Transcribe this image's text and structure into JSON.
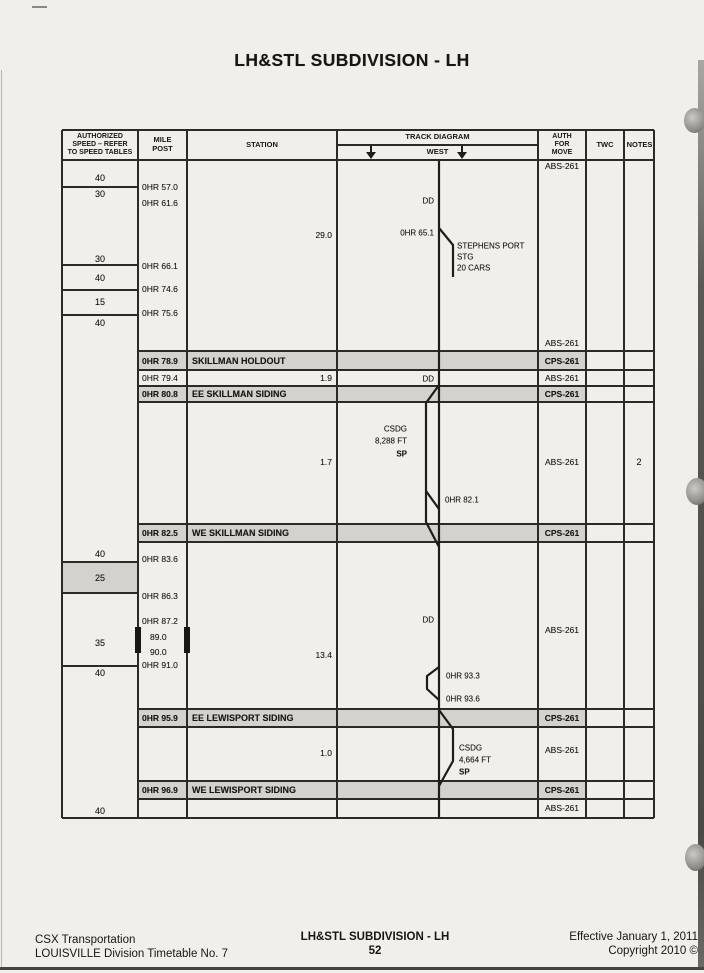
{
  "title": "LH&STL SUBDIVISION  - LH",
  "table_header": {
    "speed": [
      "AUTHORIZED",
      "SPEED – REFER",
      "TO SPEED TABLES"
    ],
    "milepost": [
      "MILE",
      "POST"
    ],
    "station": "STATION",
    "track_diagram": "TRACK DIAGRAM",
    "track_direction": "WEST",
    "auth": [
      "AUTH",
      "FOR",
      "MOVE"
    ],
    "twc": "TWC",
    "notes": "NOTES"
  },
  "speed_labels": [
    {
      "text": "40",
      "y": 178
    },
    {
      "text": "30",
      "y": 194
    },
    {
      "text": "30",
      "y": 259
    },
    {
      "text": "40",
      "y": 278
    },
    {
      "text": "15",
      "y": 302
    },
    {
      "text": "40",
      "y": 323
    },
    {
      "text": "40",
      "y": 554
    },
    {
      "text": "25",
      "y": 578,
      "shaded": true
    },
    {
      "text": "35",
      "y": 643
    },
    {
      "text": "40",
      "y": 673
    },
    {
      "text": "40",
      "y": 811
    }
  ],
  "mileposts": [
    {
      "text": "0HR 57.0",
      "y": 187
    },
    {
      "text": "0HR 61.6",
      "y": 203
    },
    {
      "text": "0HR 66.1",
      "y": 266
    },
    {
      "text": "0HR 74.6",
      "y": 289
    },
    {
      "text": "0HR 75.6",
      "y": 313
    },
    {
      "text": "0HR 79.4",
      "y": 378
    },
    {
      "text": "0HR 83.6",
      "y": 559
    },
    {
      "text": "0HR 86.3",
      "y": 596
    },
    {
      "text": "0HR 87.2",
      "y": 621
    },
    {
      "text": "89.0",
      "y": 637,
      "indent": true
    },
    {
      "text": "90.0",
      "y": 652,
      "indent": true
    },
    {
      "text": "0HR 91.0",
      "y": 665
    }
  ],
  "station_bands": [
    {
      "milepost": "0HR 78.9",
      "station": "SKILLMAN HOLDOUT",
      "auth": "CPS-261",
      "top": 351,
      "height": 19
    },
    {
      "milepost": "0HR 80.8",
      "station": "EE SKILLMAN SIDING",
      "auth": "CPS-261",
      "top": 386,
      "height": 16
    },
    {
      "milepost": "0HR 82.5",
      "station": "WE SKILLMAN SIDING",
      "auth": "CPS-261",
      "top": 524,
      "height": 18
    },
    {
      "milepost": "0HR 95.9",
      "station": "EE LEWISPORT SIDING",
      "auth": "CPS-261",
      "top": 709,
      "height": 18
    },
    {
      "milepost": "0HR 96.9",
      "station": "WE LEWISPORT SIDING",
      "auth": "CPS-261",
      "top": 781,
      "height": 18
    }
  ],
  "distances": [
    {
      "text": "29.0",
      "y": 235
    },
    {
      "text": "1.9",
      "y": 378
    },
    {
      "text": "1.7",
      "y": 462
    },
    {
      "text": "13.4",
      "y": 655
    },
    {
      "text": "1.0",
      "y": 753
    }
  ],
  "auth_labels": [
    {
      "text": "ABS-261",
      "y": 166
    },
    {
      "text": "ABS-261",
      "y": 343
    },
    {
      "text": "ABS-261",
      "y": 378
    },
    {
      "text": "ABS-261",
      "y": 462
    },
    {
      "text": "ABS-261",
      "y": 630
    },
    {
      "text": "ABS-261",
      "y": 750
    },
    {
      "text": "ABS-261",
      "y": 808
    }
  ],
  "notes_labels": [
    {
      "text": "2",
      "y": 462
    }
  ],
  "track_labels": [
    {
      "text": "DD",
      "x": 434,
      "y": 201,
      "align": "right"
    },
    {
      "text": "0HR 65.1",
      "x": 434,
      "y": 233,
      "align": "right"
    },
    {
      "text": "STEPHENS PORT",
      "x": 457,
      "y": 246,
      "align": "left"
    },
    {
      "text": "STG",
      "x": 457,
      "y": 257,
      "align": "left"
    },
    {
      "text": "20 CARS",
      "x": 457,
      "y": 268,
      "align": "left"
    },
    {
      "text": "DD",
      "x": 434,
      "y": 379,
      "align": "right"
    },
    {
      "text": "CSDG",
      "x": 407,
      "y": 429,
      "align": "right"
    },
    {
      "text": "8,288 FT",
      "x": 407,
      "y": 441,
      "align": "right"
    },
    {
      "text": "SP",
      "x": 407,
      "y": 454,
      "align": "right",
      "bold": true
    },
    {
      "text": "0HR 82.1",
      "x": 445,
      "y": 500,
      "align": "left"
    },
    {
      "text": "DD",
      "x": 434,
      "y": 620,
      "align": "right"
    },
    {
      "text": "0HR 93.3",
      "x": 446,
      "y": 676,
      "align": "left"
    },
    {
      "text": "0HR 93.6",
      "x": 446,
      "y": 699,
      "align": "left"
    },
    {
      "text": "CSDG",
      "x": 459,
      "y": 748,
      "align": "left"
    },
    {
      "text": "4,664 FT",
      "x": 459,
      "y": 760,
      "align": "left"
    },
    {
      "text": "SP",
      "x": 459,
      "y": 772,
      "align": "left",
      "bold": true
    }
  ],
  "footer": {
    "left_line1": "CSX Transportation",
    "left_line2": "LOUISVILLE Division Timetable No. 7",
    "center_line1": "LH&STL SUBDIVISION - LH",
    "page_number": "52",
    "right_line1": "Effective January 1, 2011",
    "right_line2": "Copyright 2010 ©"
  },
  "colors": {
    "band_gray": "#d3d2cd",
    "line": "#2b2a26",
    "paper": "#f0efeb"
  }
}
